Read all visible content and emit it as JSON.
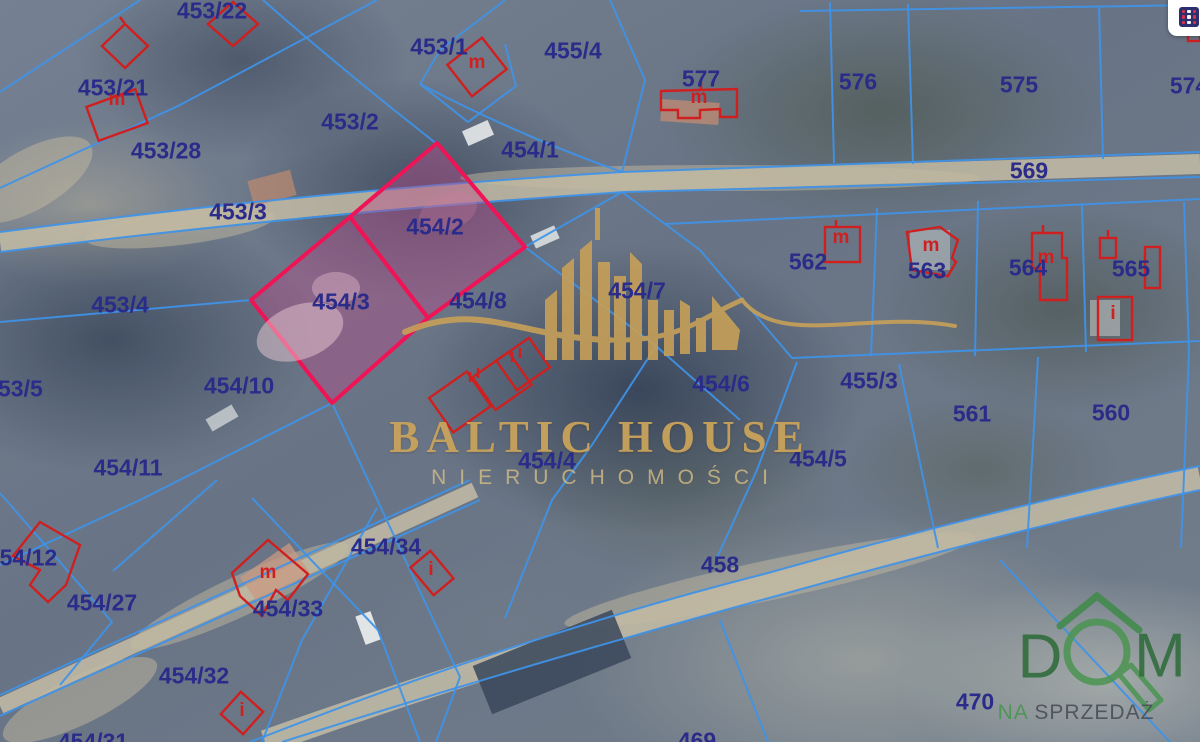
{
  "map": {
    "colors": {
      "parcel_line": "#3f93e8",
      "parcel_label": "#2b2b8a",
      "building_outline": "#cf1f1f",
      "highlight_border": "#ee1456",
      "highlight_fill": "rgba(186,74,138,0.42)",
      "road": "#c9c0a8",
      "watermark_gold": "#c9a35b"
    },
    "highlight": {
      "parcel_ids": [
        "454/2",
        "454/3"
      ]
    },
    "parcels": [
      {
        "label": "453/22",
        "x": 212,
        "y": 11
      },
      {
        "label": "453/21",
        "x": 113,
        "y": 88
      },
      {
        "label": "453/28",
        "x": 166,
        "y": 151
      },
      {
        "label": "453/2",
        "x": 350,
        "y": 122
      },
      {
        "label": "453/1",
        "x": 439,
        "y": 47
      },
      {
        "label": "455/4",
        "x": 573,
        "y": 51
      },
      {
        "label": "577",
        "x": 701,
        "y": 79
      },
      {
        "label": "576",
        "x": 858,
        "y": 82
      },
      {
        "label": "575",
        "x": 1019,
        "y": 85
      },
      {
        "label": "574",
        "x": 1189,
        "y": 86
      },
      {
        "label": "569",
        "x": 1029,
        "y": 171
      },
      {
        "label": "453/3",
        "x": 238,
        "y": 212
      },
      {
        "label": "454/1",
        "x": 530,
        "y": 150
      },
      {
        "label": "454/2",
        "x": 435,
        "y": 227
      },
      {
        "label": "453/4",
        "x": 120,
        "y": 305
      },
      {
        "label": "454/3",
        "x": 341,
        "y": 302
      },
      {
        "label": "454/8",
        "x": 478,
        "y": 301
      },
      {
        "label": "454/7",
        "x": 637,
        "y": 291
      },
      {
        "label": "562",
        "x": 808,
        "y": 262
      },
      {
        "label": "563",
        "x": 927,
        "y": 271
      },
      {
        "label": "564",
        "x": 1028,
        "y": 268
      },
      {
        "label": "565",
        "x": 1131,
        "y": 269
      },
      {
        "label": "453/5",
        "x": 14,
        "y": 389
      },
      {
        "label": "454/10",
        "x": 239,
        "y": 386
      },
      {
        "label": "454/6",
        "x": 721,
        "y": 384
      },
      {
        "label": "455/3",
        "x": 869,
        "y": 381
      },
      {
        "label": "561",
        "x": 972,
        "y": 414
      },
      {
        "label": "560",
        "x": 1111,
        "y": 413
      },
      {
        "label": "454/11",
        "x": 128,
        "y": 468
      },
      {
        "label": "454/4",
        "x": 547,
        "y": 461
      },
      {
        "label": "454/5",
        "x": 818,
        "y": 459
      },
      {
        "label": "454/12",
        "x": 22,
        "y": 558
      },
      {
        "label": "454/34",
        "x": 386,
        "y": 547
      },
      {
        "label": "458",
        "x": 720,
        "y": 565
      },
      {
        "label": "454/27",
        "x": 102,
        "y": 603
      },
      {
        "label": "454/33",
        "x": 288,
        "y": 609
      },
      {
        "label": "454/32",
        "x": 194,
        "y": 676
      },
      {
        "label": "470",
        "x": 975,
        "y": 702
      },
      {
        "label": "469",
        "x": 697,
        "y": 741
      },
      {
        "label": "454/31",
        "x": 93,
        "y": 742
      }
    ],
    "building_marks": [
      {
        "letter": "m",
        "x": 117,
        "y": 100
      },
      {
        "letter": "m",
        "x": 477,
        "y": 63
      },
      {
        "letter": "m",
        "x": 699,
        "y": 98
      },
      {
        "letter": "m",
        "x": 841,
        "y": 238
      },
      {
        "letter": "m",
        "x": 931,
        "y": 246
      },
      {
        "letter": "m",
        "x": 1046,
        "y": 258
      },
      {
        "letter": "i",
        "x": 1113,
        "y": 314
      },
      {
        "letter": "m",
        "x": 268,
        "y": 573
      },
      {
        "letter": "i",
        "x": 431,
        "y": 570
      },
      {
        "letter": "i",
        "x": 242,
        "y": 711
      }
    ]
  },
  "watermark": {
    "title": "BALTIC HOUSE",
    "subtitle": "NIERUCHOMOŚCI"
  },
  "logo": {
    "letter_d": "D",
    "letter_m": "M",
    "tagline_prefix": "NA",
    "tagline_word": "SPRZEDAŻ",
    "green": "#4a9552",
    "dark_green": "#2e6b39"
  },
  "controls": {
    "layers_button_icon": "legend-grid-icon"
  }
}
